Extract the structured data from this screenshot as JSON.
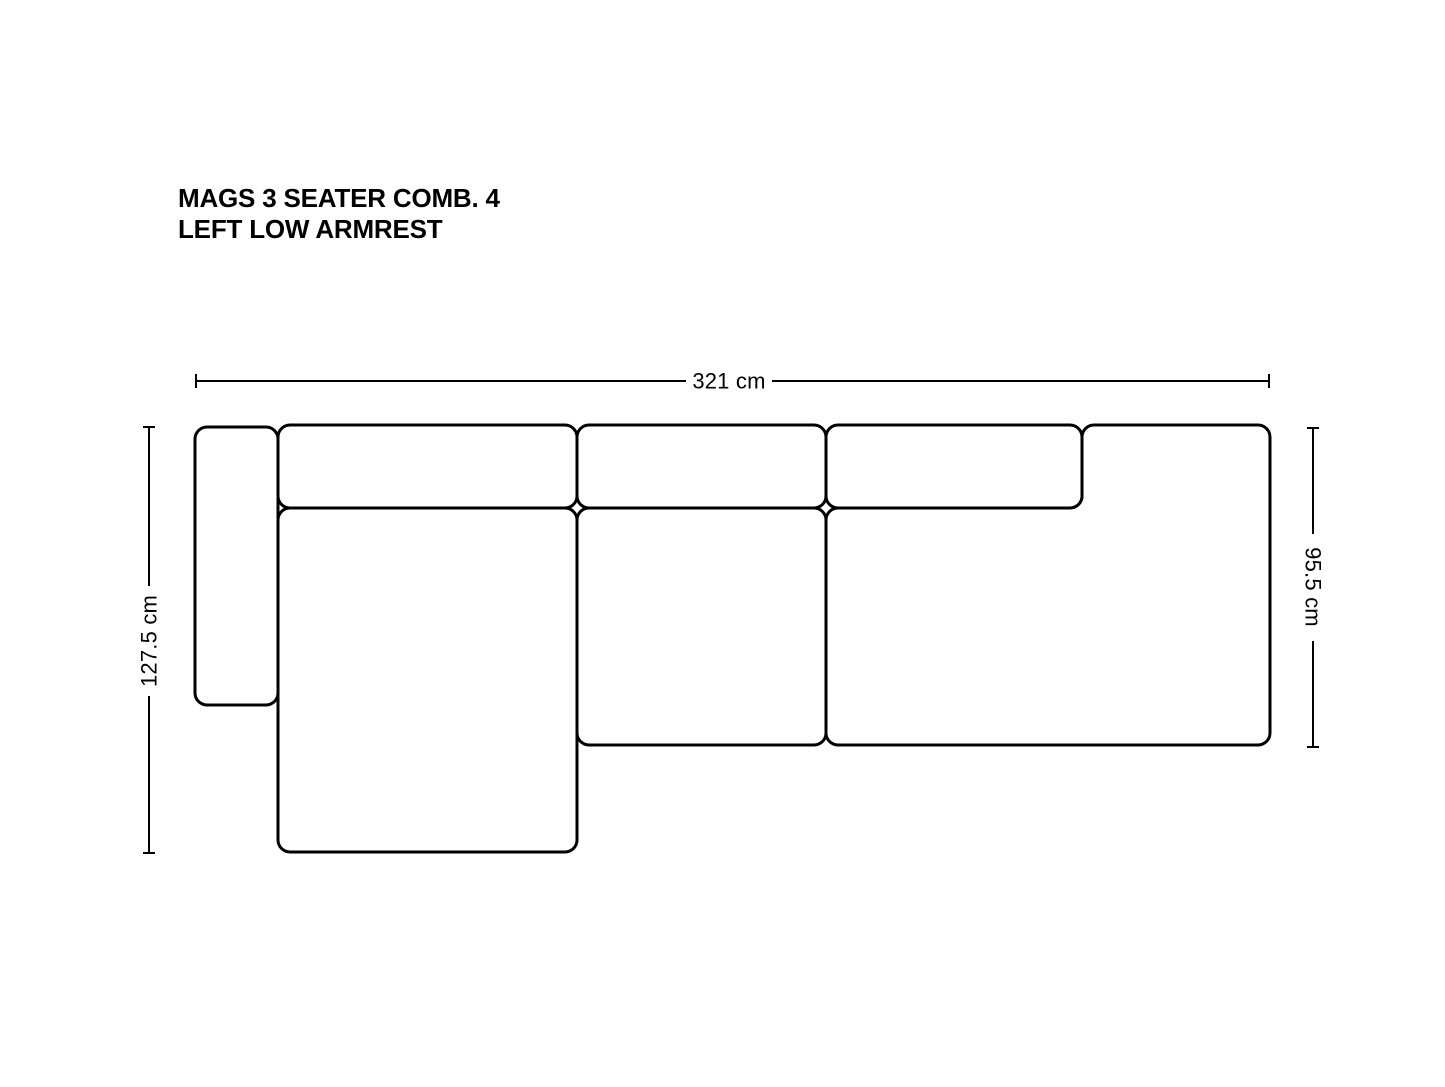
{
  "page": {
    "background_color": "#ffffff",
    "line_color": "#000000"
  },
  "title": {
    "line1": "MAGS 3 SEATER COMB. 4",
    "line2": "LEFT LOW ARMREST"
  },
  "dimensions": {
    "overall_width_label": "321 cm",
    "left_depth_label": "127.5 cm",
    "right_depth_label": "95.5 cm"
  }
}
